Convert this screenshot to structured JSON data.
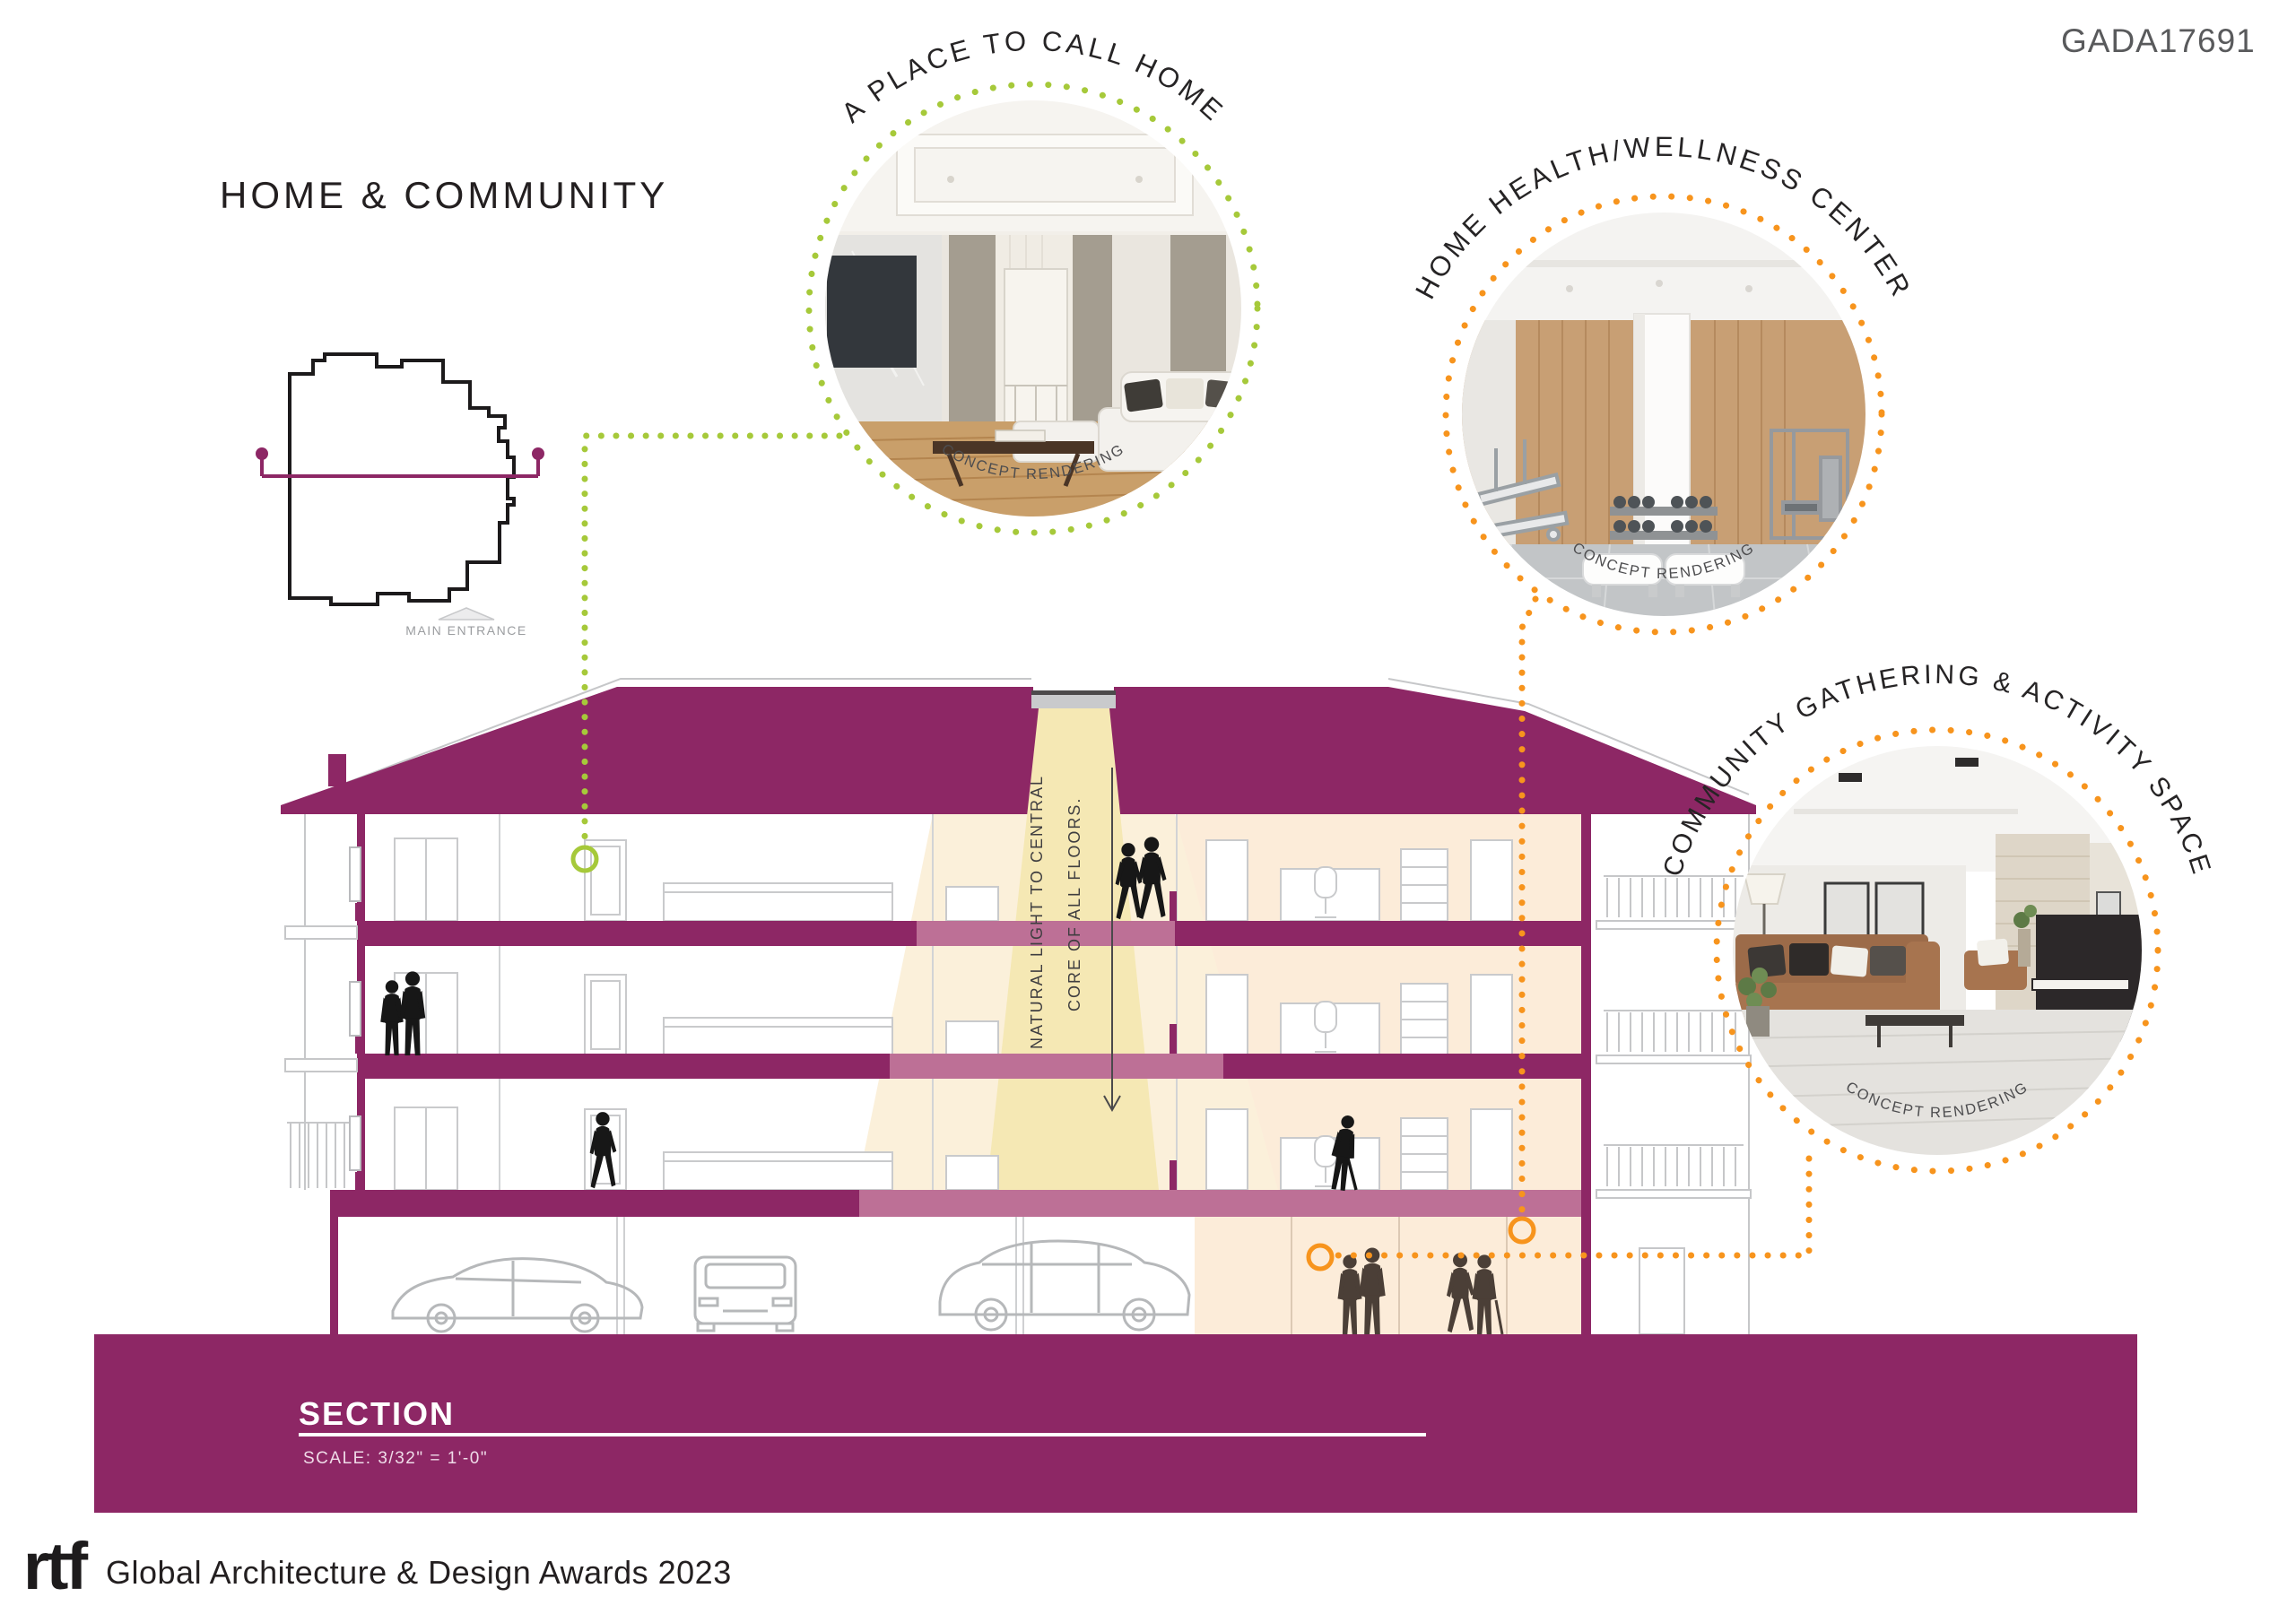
{
  "board": {
    "code": "GADA17691",
    "title": "HOME & COMMUNITY",
    "plan": {
      "label": "MAIN ENTRANCE"
    },
    "callouts": [
      {
        "label": "A PLACE TO CALL HOME",
        "caption": "CONCEPT RENDERING",
        "accent": "#a6c93a"
      },
      {
        "label": "HOME HEALTH/WELLNESS CENTER",
        "caption": "CONCEPT RENDERING",
        "accent": "#f7941d"
      },
      {
        "label": "COMMUNITY GATHERING & ACTIVITY SPACE",
        "caption": "CONCEPT RENDERING",
        "accent": "#f7941d"
      }
    ],
    "section": {
      "annotation_line1": "NATURAL LIGHT TO CENTRAL",
      "annotation_line2": "CORE OF ALL FLOORS.",
      "label": "SECTION",
      "scale": "SCALE: 3/32\" = 1'-0\""
    },
    "footer": {
      "logo": "rtf",
      "text": "Global Architecture & Design Awards 2023"
    },
    "colors": {
      "magenta": "#8d2765",
      "slab_rose": "#bd7096",
      "green": "#a6c93a",
      "orange": "#f7941d",
      "light_cone": "#f5e8b4",
      "pale_cone": "#fbf0da",
      "peach": "#fcecd9",
      "ink": "#231f20",
      "gray": "#58595b",
      "line_gray": "#c6c7c9"
    }
  }
}
